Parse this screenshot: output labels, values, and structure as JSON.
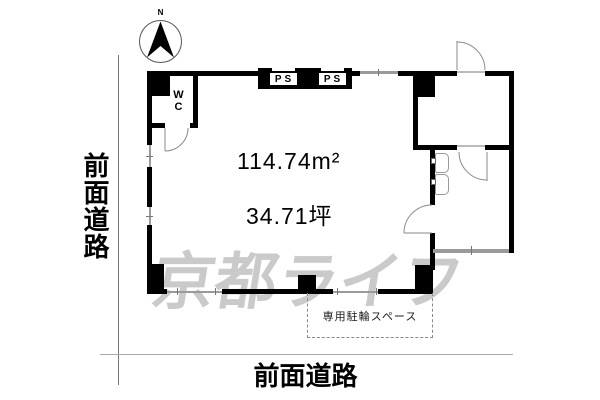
{
  "title": "floor-plan",
  "compass": {
    "label": "N"
  },
  "labels": {
    "road_left": "前面道路",
    "road_bottom": "前面道路",
    "area_m2": "114.74m²",
    "area_tsubo": "34.71坪",
    "wc": "WC",
    "ps": [
      "PS",
      "PS"
    ],
    "bicycle_space": "専用駐輪スペース",
    "watermark": "京都ライフ"
  },
  "colors": {
    "wall": "#000000",
    "window_line": "#9a9a9a",
    "door_arc": "#8a8a8a",
    "watermark_gray": "#bcbcbc",
    "road_line": "#a9a9a9"
  }
}
